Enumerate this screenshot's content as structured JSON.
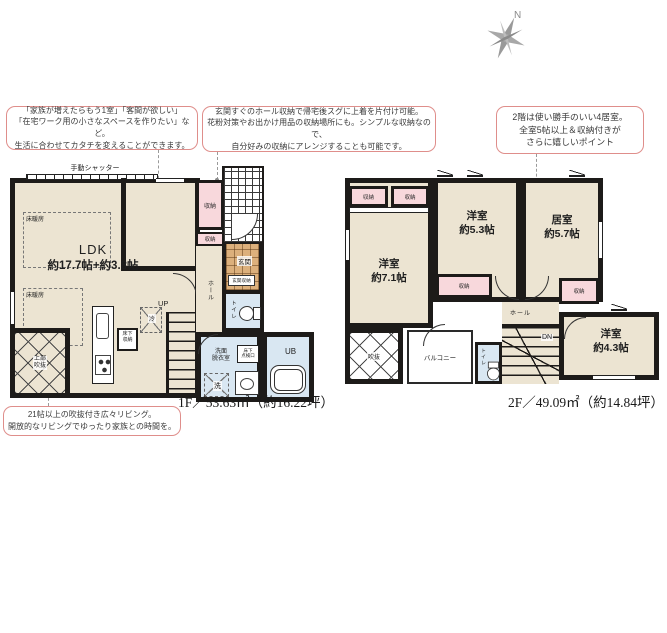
{
  "colors": {
    "wall": "#1d1b19",
    "floor_beige": "#ece4d2",
    "closet_pink": "#f8d8dc",
    "tile_orange": "#dcb07c",
    "wet_blue": "#d9e7f2",
    "callout_border": "#df8e8b"
  },
  "compass": {
    "label": "N"
  },
  "callouts": [
    {
      "lines": [
        "「家族が増えたらもう1室」「客間が欲しい」",
        "「在宅ワーク用の小さなスペースを作りたい」など。",
        "生活に合わせてカタチを変えることができます。"
      ]
    },
    {
      "lines": [
        "玄関すぐのホール収納で帰宅後スグに上着を片付け可能。",
        "花粉対策やお出かけ用品の収納場所にも。シンプルな収納なので、",
        "自分好みの収納にアレンジすることも可能です。"
      ]
    },
    {
      "lines": [
        "2階は使い勝手のいい4居室。",
        "全室5帖以上＆収納付きが",
        "さらに嬉しいポイント"
      ]
    },
    {
      "lines": [
        "21帖以上の吹抜付き広々リビング。",
        "開放的なリビングでゆったり家族との時間を。"
      ]
    }
  ],
  "f1": {
    "title": "1F／53.63㎡（約16.22坪）",
    "labels": {
      "shutter": "手動シャッター",
      "floor_heating": "床暖房",
      "ldk_name": "LDK",
      "ldk_size": "約17.7帖+約3.8帖",
      "storage": "収納",
      "storage_small": "収納",
      "void_l1": "上部",
      "void_l2": "吹抜",
      "underfloor_l1": "床下",
      "underfloor_l2": "収納",
      "fridge": "冷",
      "up": "UP",
      "hall": "ホール",
      "genkan": "玄関",
      "genkan_storage": "玄関収納",
      "toilet": "トイレ",
      "washroom_l1": "洗面",
      "washroom_l2": "脱衣室",
      "inspection_l1": "床下",
      "inspection_l2": "点検口",
      "washer": "洗",
      "bath": "UB"
    }
  },
  "f2": {
    "title": "2F／49.09㎡（約14.84坪）",
    "labels": {
      "storage": "収納",
      "room1_name": "洋室",
      "room1_size": "約7.1帖",
      "room2_name": "洋室",
      "room2_size": "約5.3帖",
      "room3_name": "居室",
      "room3_size": "約5.7帖",
      "room4_name": "洋室",
      "room4_size": "約4.3帖",
      "void": "吹抜",
      "balcony": "バルコニー",
      "toilet": "トイレ",
      "hall": "ホール",
      "dn": "DN"
    }
  }
}
